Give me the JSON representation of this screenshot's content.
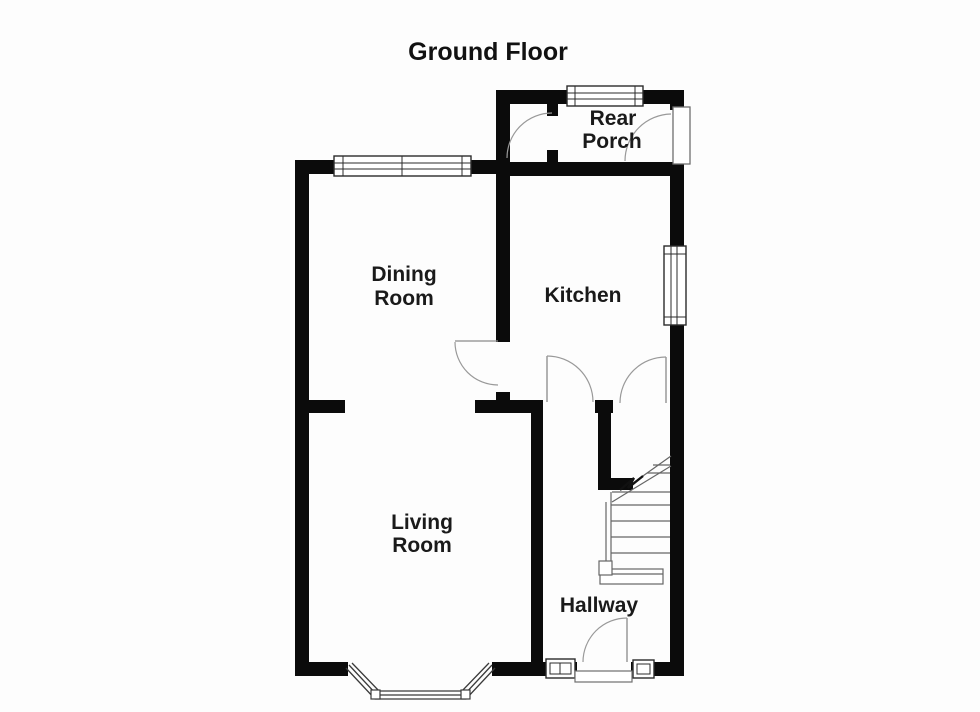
{
  "title": "Ground Floor",
  "rooms": {
    "rear_porch": {
      "line1": "Rear",
      "line2": "Porch"
    },
    "dining_room": {
      "line1": "Dining",
      "line2": "Room"
    },
    "kitchen": {
      "line1": "Kitchen"
    },
    "living_room": {
      "line1": "Living",
      "line2": "Room"
    },
    "hallway": {
      "line1": "Hallway"
    }
  },
  "colors": {
    "background": "#fdfdfd",
    "wall": "#0b0b0b",
    "text": "#1a1a1a",
    "door_arc": "#999999",
    "window_frame": "#2b2b2b",
    "stair_line": "#666666"
  }
}
